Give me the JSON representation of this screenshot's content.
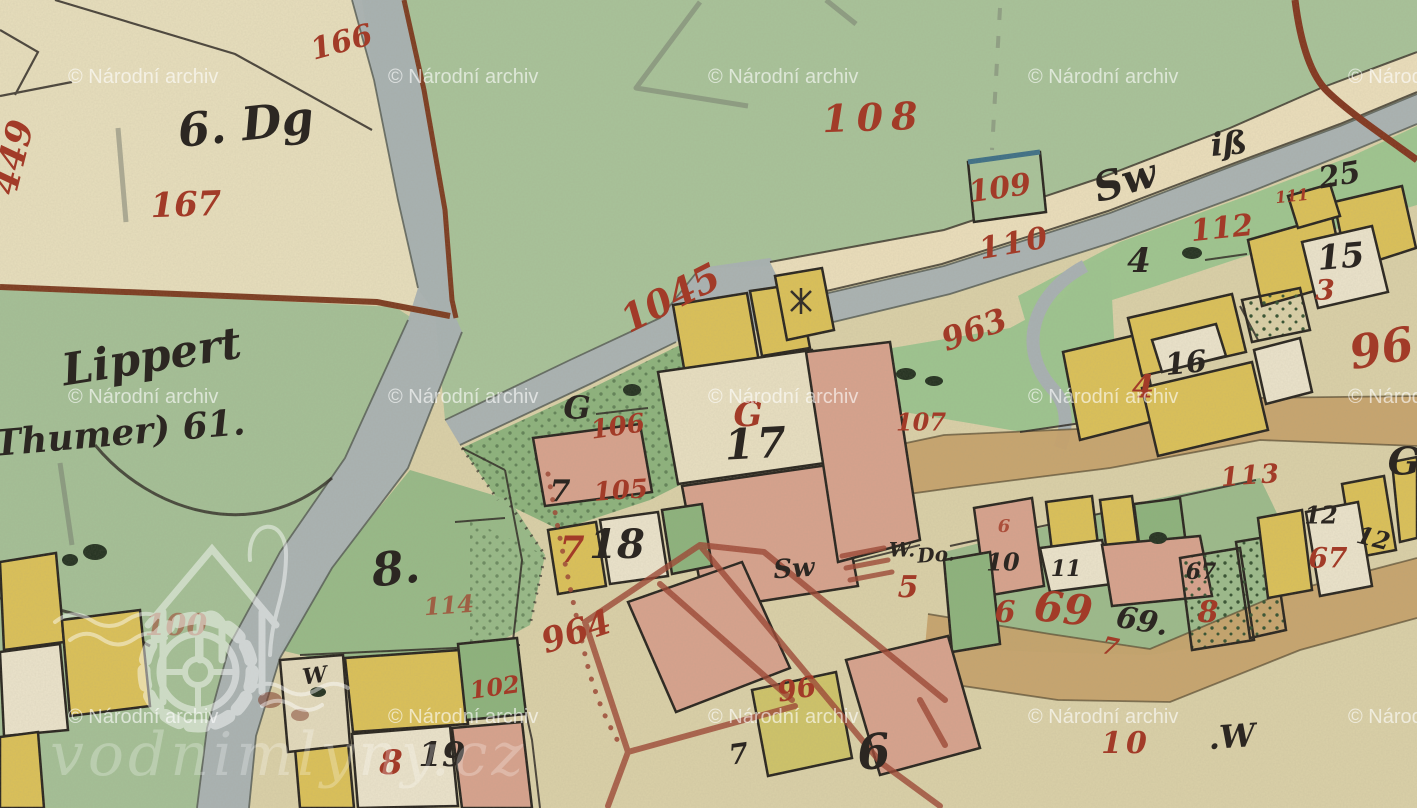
{
  "watermark": {
    "archive_text": "© Národní archiv",
    "columns_x": [
      68,
      388,
      708,
      1028,
      1348
    ],
    "rows_y": [
      83,
      403,
      723
    ],
    "opacity": 0.62,
    "logo_text": "vodnimlyny.cz"
  },
  "colors": {
    "red": "#a23b28",
    "ink": "#2c2722",
    "brown": "#7c3a1e",
    "paper": "#dbd1a8",
    "field_beige": "#e8dfbd",
    "green": "#a8c399",
    "garden_green": "#8cb37c",
    "water_gray": "#a8b1b3",
    "road_cream": "#ecdfbc",
    "road_tan": "#c7a26a",
    "building_yellow": "#dcc157",
    "building_pink": "#d8a28d",
    "building_white": "#ece4cc",
    "survey_red": "#9c4431",
    "watermark_white": "#ffffff",
    "water_blue_edge": "#3c6f86"
  },
  "map": {
    "labels": [
      {
        "t": "166",
        "x": 342,
        "y": 44,
        "s": 30,
        "r": -15,
        "c": "red"
      },
      {
        "t": "167",
        "x": 186,
        "y": 207,
        "s": 34,
        "r": -2,
        "c": "red"
      },
      {
        "t": "449",
        "x": 16,
        "y": 158,
        "s": 36,
        "r": -76,
        "c": "red"
      },
      {
        "t": "108",
        "x": 874,
        "y": 121,
        "s": 38,
        "r": -2,
        "c": "red",
        "ls": 8
      },
      {
        "t": "109",
        "x": 1000,
        "y": 190,
        "s": 30,
        "r": -8,
        "c": "red"
      },
      {
        "t": "110",
        "x": 1015,
        "y": 245,
        "s": 30,
        "r": -10,
        "c": "red",
        "ls": 3
      },
      {
        "t": "1045",
        "x": 672,
        "y": 301,
        "s": 38,
        "r": -27,
        "c": "red"
      },
      {
        "t": "963",
        "x": 975,
        "y": 332,
        "s": 32,
        "r": -20,
        "c": "red"
      },
      {
        "t": "96",
        "x": 1382,
        "y": 352,
        "s": 46,
        "r": -10,
        "c": "red"
      },
      {
        "t": "112",
        "x": 1222,
        "y": 230,
        "s": 30,
        "r": -6,
        "c": "red"
      },
      {
        "t": "111",
        "x": 1292,
        "y": 197,
        "s": 16,
        "r": -6,
        "c": "red"
      },
      {
        "t": "4",
        "x": 1143,
        "y": 389,
        "s": 32,
        "r": 0,
        "c": "red"
      },
      {
        "t": "113",
        "x": 1251,
        "y": 477,
        "s": 26,
        "r": -4,
        "c": "red",
        "ls": 2
      },
      {
        "t": "106",
        "x": 618,
        "y": 428,
        "s": 26,
        "r": -8,
        "c": "red"
      },
      {
        "t": "105",
        "x": 621,
        "y": 492,
        "s": 26,
        "r": -4,
        "c": "red"
      },
      {
        "t": "G",
        "x": 748,
        "y": 417,
        "s": 34,
        "r": 0,
        "c": "red"
      },
      {
        "t": "107",
        "x": 921,
        "y": 424,
        "s": 24,
        "r": 0,
        "c": "red"
      },
      {
        "t": "114",
        "x": 449,
        "y": 607,
        "s": 24,
        "r": -4,
        "c": "red",
        "o": 0.7
      },
      {
        "t": "964",
        "x": 577,
        "y": 634,
        "s": 34,
        "r": -18,
        "c": "red"
      },
      {
        "t": "100",
        "x": 176,
        "y": 627,
        "s": 30,
        "r": 0,
        "c": "red",
        "o": 0.5
      },
      {
        "t": "102",
        "x": 495,
        "y": 689,
        "s": 24,
        "r": -8,
        "c": "red"
      },
      {
        "t": "7",
        "x": 572,
        "y": 553,
        "s": 36,
        "r": 0,
        "c": "red"
      },
      {
        "t": "5",
        "x": 908,
        "y": 589,
        "s": 30,
        "r": 0,
        "c": "red"
      },
      {
        "t": "96",
        "x": 797,
        "y": 691,
        "s": 28,
        "r": -10,
        "c": "red"
      },
      {
        "t": "69",
        "x": 1063,
        "y": 612,
        "s": 42,
        "r": 6,
        "c": "red"
      },
      {
        "t": "6",
        "x": 1005,
        "y": 614,
        "s": 30,
        "r": 0,
        "c": "red"
      },
      {
        "t": "6",
        "x": 1004,
        "y": 527,
        "s": 18,
        "r": 0,
        "c": "red",
        "o": 0.8
      },
      {
        "t": "8",
        "x": 1208,
        "y": 614,
        "s": 30,
        "r": 0,
        "c": "red"
      },
      {
        "t": "67",
        "x": 1328,
        "y": 560,
        "s": 28,
        "r": 0,
        "c": "red"
      },
      {
        "t": "10",
        "x": 1126,
        "y": 745,
        "s": 30,
        "r": 0,
        "c": "red",
        "ls": 4
      },
      {
        "t": "8",
        "x": 391,
        "y": 765,
        "s": 34,
        "r": 0,
        "c": "red"
      },
      {
        "t": "3",
        "x": 1325,
        "y": 292,
        "s": 28,
        "r": 0,
        "c": "red"
      },
      {
        "t": "7",
        "x": 1110,
        "y": 648,
        "s": 24,
        "r": 12,
        "c": "red"
      },
      {
        "t": "6. Dg",
        "x": 246,
        "y": 128,
        "s": 46,
        "r": -6,
        "c": "ink"
      },
      {
        "t": "Lippert",
        "x": 152,
        "y": 360,
        "s": 44,
        "r": -9,
        "c": "ink"
      },
      {
        "t": "Thumer) 61.",
        "x": 120,
        "y": 436,
        "s": 36,
        "r": -5,
        "c": "ink"
      },
      {
        "t": "Sw",
        "x": 1126,
        "y": 184,
        "s": 40,
        "r": -16,
        "c": "ink"
      },
      {
        "t": "iß",
        "x": 1229,
        "y": 146,
        "s": 32,
        "r": -5,
        "c": "ink"
      },
      {
        "t": "25",
        "x": 1340,
        "y": 177,
        "s": 30,
        "r": -10,
        "c": "ink"
      },
      {
        "t": "4",
        "x": 1139,
        "y": 263,
        "s": 34,
        "r": 0,
        "c": "ink"
      },
      {
        "t": "15",
        "x": 1341,
        "y": 259,
        "s": 34,
        "r": -5,
        "c": "ink"
      },
      {
        "t": "16",
        "x": 1186,
        "y": 365,
        "s": 30,
        "r": -6,
        "c": "ink"
      },
      {
        "t": "17",
        "x": 757,
        "y": 447,
        "s": 42,
        "r": -3,
        "c": "ink",
        "ls": 3
      },
      {
        "t": "G",
        "x": 577,
        "y": 410,
        "s": 32,
        "r": 0,
        "c": "ink"
      },
      {
        "t": "G",
        "x": 1404,
        "y": 465,
        "s": 38,
        "r": 0,
        "c": "ink"
      },
      {
        "t": "7",
        "x": 560,
        "y": 493,
        "s": 30,
        "r": 0,
        "c": "ink"
      },
      {
        "t": "8.",
        "x": 396,
        "y": 572,
        "s": 46,
        "r": -6,
        "c": "ink"
      },
      {
        "t": "Sw",
        "x": 794,
        "y": 570,
        "s": 26,
        "r": -4,
        "c": "ink"
      },
      {
        "t": "W.",
        "x": 902,
        "y": 551,
        "s": 20,
        "r": 0,
        "c": "ink"
      },
      {
        "t": "Do.",
        "x": 936,
        "y": 556,
        "s": 20,
        "r": -4,
        "c": "ink"
      },
      {
        "t": "10",
        "x": 1003,
        "y": 564,
        "s": 24,
        "r": 0,
        "c": "ink"
      },
      {
        "t": "11",
        "x": 1066,
        "y": 570,
        "s": 22,
        "r": 0,
        "c": "ink"
      },
      {
        "t": "69.",
        "x": 1142,
        "y": 623,
        "s": 30,
        "r": 10,
        "c": "ink"
      },
      {
        "t": "67",
        "x": 1201,
        "y": 573,
        "s": 22,
        "r": 0,
        "c": "ink"
      },
      {
        "t": "12",
        "x": 1321,
        "y": 517,
        "s": 24,
        "r": 0,
        "c": "ink"
      },
      {
        "t": "12",
        "x": 1373,
        "y": 540,
        "s": 24,
        "r": 14,
        "c": "ink"
      },
      {
        "t": "19",
        "x": 442,
        "y": 757,
        "s": 34,
        "r": 0,
        "c": "ink"
      },
      {
        "t": "6",
        "x": 874,
        "y": 756,
        "s": 48,
        "r": -6,
        "c": "ink"
      },
      {
        "t": ".W",
        "x": 1232,
        "y": 739,
        "s": 32,
        "r": -4,
        "c": "ink"
      },
      {
        "t": "18",
        "x": 617,
        "y": 548,
        "s": 40,
        "r": 0,
        "c": "ink"
      },
      {
        "t": "W",
        "x": 315,
        "y": 677,
        "s": 22,
        "r": -8,
        "c": "ink"
      },
      {
        "t": "7",
        "x": 739,
        "y": 756,
        "s": 28,
        "r": -8,
        "c": "ink"
      }
    ]
  }
}
